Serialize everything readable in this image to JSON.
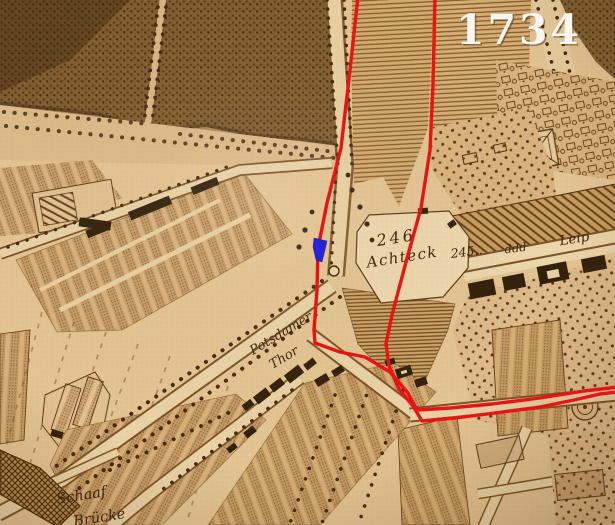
{
  "map": {
    "year_label": "1734",
    "labels": {
      "num_246": "246",
      "achteck": "Achteck",
      "num_245": "245..",
      "ddd": "ddd",
      "leip": "Leip",
      "potsdamer": "Potsdamer",
      "thor": "Thor",
      "schaaf": "Schaaf",
      "bruecke": "Brücke"
    },
    "colors": {
      "overlay_red": "#e91412",
      "marker_blue": "#2823d8",
      "year_text": "#f8f6f0",
      "ink": "#3a2309",
      "parchment": "#e3c493"
    }
  }
}
